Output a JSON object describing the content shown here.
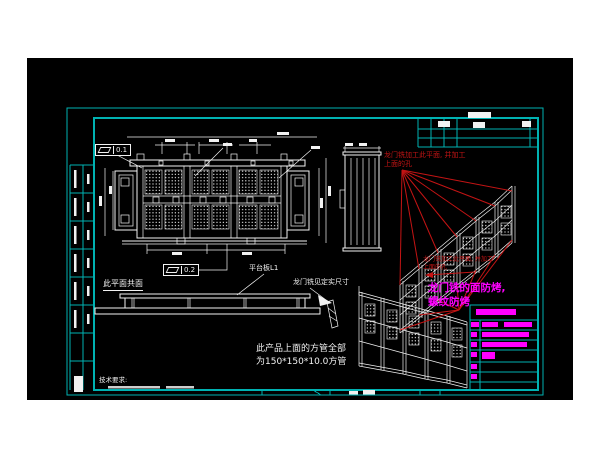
{
  "colors": {
    "page": "#ffffff",
    "bg": "#000000",
    "frame": "#00b2b2",
    "line": "#f2f2f2",
    "red": "#c41414",
    "magenta": "#ff00ff"
  },
  "tolerances": {
    "fcf1_value": "0.1",
    "fcf2_value": "0.2"
  },
  "labels": {
    "coplanar": "此平面共面",
    "platform_plate": "平台板L1",
    "gantry_mill_dim": "龙门铣见定实尺寸",
    "product_note_line1": "此产品上面的方管全部",
    "product_note_line2": "为150*150*10.0方管",
    "tech_req_title": "技术要求:"
  },
  "red_note": {
    "line1": "龙门铣加工此平面, 并加工",
    "line2": "上面的孔"
  },
  "magenta_note": {
    "line1": "龙门铣的面防烤,",
    "line2": "螺纹防烤"
  }
}
